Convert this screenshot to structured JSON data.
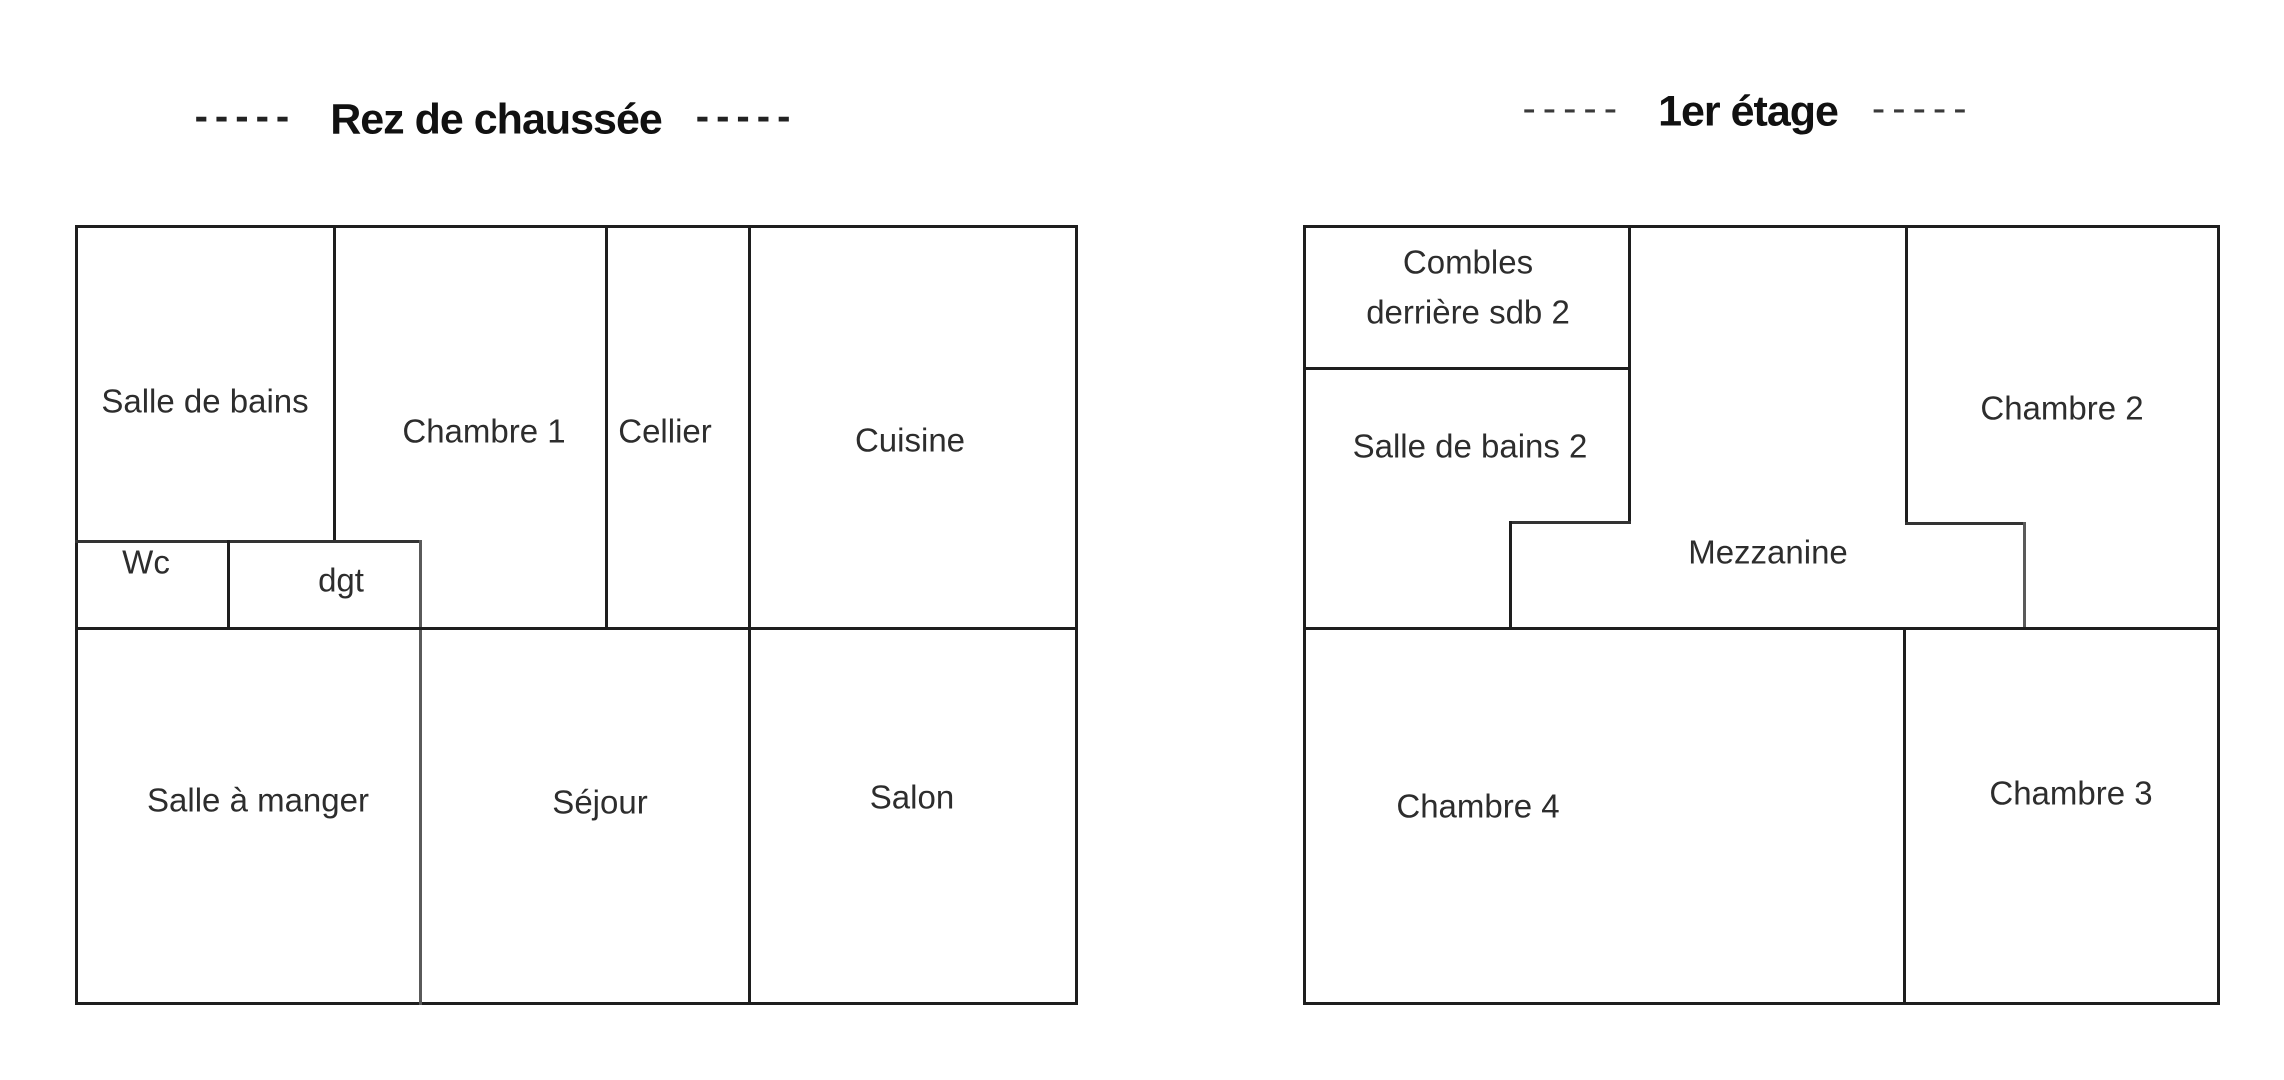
{
  "canvas": {
    "background": "#ffffff",
    "wall_color": "#1e1e1e",
    "text_color": "#2d2d2d"
  },
  "floors": [
    {
      "id": "rez-de-chaussee",
      "title": "Rez de chaussée",
      "dash_left": "-----",
      "dash_right": "-----",
      "rooms": [
        {
          "label": "Salle de bains"
        },
        {
          "label": "Chambre 1"
        },
        {
          "label": "Cellier"
        },
        {
          "label": "Cuisine"
        },
        {
          "label": "Wc"
        },
        {
          "label": "dgt"
        },
        {
          "label": "Salle à manger"
        },
        {
          "label": "Séjour"
        },
        {
          "label": "Salon"
        }
      ]
    },
    {
      "id": "premier-etage",
      "title": "1er étage",
      "dash_left": "-----",
      "dash_right": "-----",
      "rooms": [
        {
          "label": "Combles derrière sdb 2",
          "lines": [
            "Combles",
            "derrière sdb 2"
          ]
        },
        {
          "label": "Salle de bains 2"
        },
        {
          "label": "Mezzanine"
        },
        {
          "label": "Chambre 2"
        },
        {
          "label": "Chambre 4"
        },
        {
          "label": "Chambre 3"
        }
      ]
    }
  ]
}
